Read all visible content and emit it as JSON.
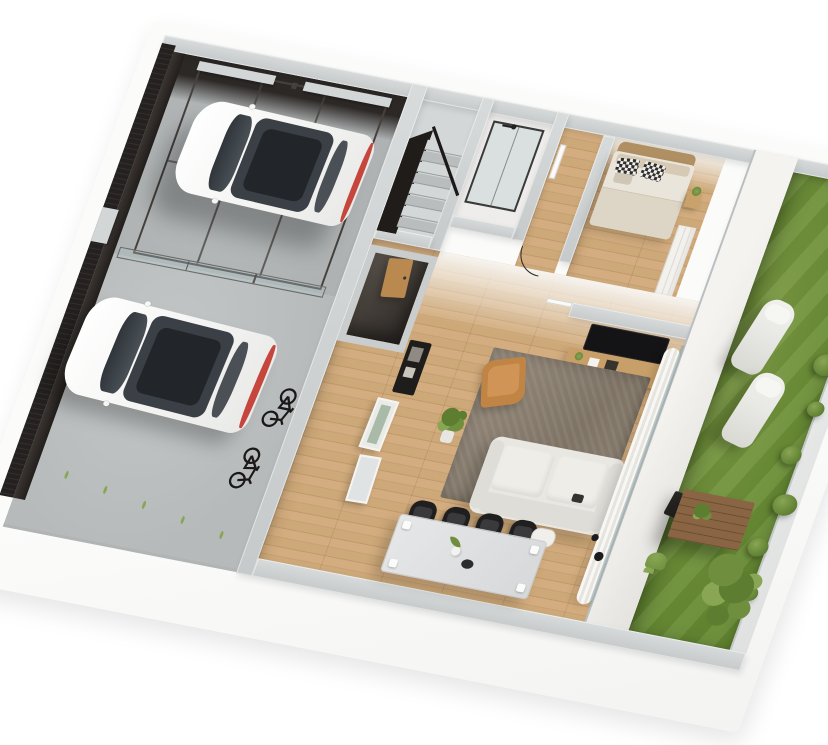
{
  "meta": {
    "title": "3D isometric cutaway floor plan render",
    "view": "top-down isometric, white background, no visible text"
  },
  "scene": {
    "areas": [
      {
        "name": "garage",
        "features": [
          "car-lift-cage",
          "white-suv-on-lift",
          "glass-garage-door",
          "dark-back-wall",
          "concrete-floor"
        ]
      },
      {
        "name": "driveway",
        "features": [
          "white-hatchback",
          "two-black-bicycles",
          "grass-tufts",
          "black-slatted-fence",
          "concrete-paving"
        ]
      },
      {
        "name": "staircase",
        "features": [
          "concrete-landing",
          "stair-treads",
          "black-stringer",
          "black-railing"
        ]
      },
      {
        "name": "bathroom",
        "features": [
          "glass-shower-enclosure",
          "black-shower-fixture"
        ]
      },
      {
        "name": "hallway",
        "features": [
          "door-swing-arc",
          "white-interior-door",
          "wood-floor"
        ]
      },
      {
        "name": "bedroom",
        "features": [
          "double-bed",
          "wood-headboard",
          "checkered-pillows",
          "nightstand-with-plant",
          "wardrobe"
        ]
      },
      {
        "name": "living-room",
        "features": [
          "wall-tv",
          "wood-media-console",
          "black-desk-lamp",
          "white-sofa",
          "taupe-rug",
          "tan-armchair",
          "potted-plant",
          "dining-table",
          "black-dining-chairs",
          "white-chair",
          "white-curtain",
          "glass-sliding-door",
          "entry-wood-door",
          "black-entry-console",
          "leaning-art-frames",
          "dark-storage-nook"
        ]
      },
      {
        "name": "garden",
        "features": [
          "lawn",
          "two-sun-loungers",
          "wooden-table-with-plant",
          "hedge-row",
          "tree",
          "corner-shrubs",
          "small-plant",
          "white-boundary-walls"
        ]
      }
    ]
  },
  "counts": {
    "stair_treads": 8,
    "dining_chairs": 4,
    "hedge_bushes": 8,
    "grass_tufts": 5,
    "lift_posts": 6,
    "cars": 2,
    "bicycles": 2,
    "sun_loungers": 2
  },
  "colors": {
    "platform": "#fbfbfa",
    "wallTop": "#c6cacb",
    "wallTopLight": "#d8dbdb",
    "wallWhite": "#f3f2ef",
    "wallShade": "#e4e3df",
    "fence": "#242120",
    "fenceSlat": "#322e2b",
    "darkWall": "#2c2826",
    "garageFloor": "#b7bbbc",
    "driveFloor": "#c3c6c6",
    "stairLight": "#d4d7d7",
    "stairDark": "#b9bdbe",
    "stringer": "#1f1c1a",
    "bathFloor": "#eeedeb",
    "glassTint": "rgba(176,196,201,0.33)",
    "glassFrame": "#3a3a3a",
    "wood1": "#d3ad7f",
    "wood2": "#c7a173",
    "wood3": "#cda878",
    "wood4": "#c19a6c",
    "woodLine": "rgba(122,86,49,0.16)",
    "storageDark": "#2e2a26",
    "storageLight": "#57504a",
    "rim": "#c9cdce",
    "bedFrame": "#b08f63",
    "mattress": "#eae5da",
    "blanket": "#ddd5c6",
    "pillowBeige": "#d6cab4",
    "check1": "#2e2e2e",
    "check2": "#f2efe9",
    "nightstand": "#c9a26b",
    "tv": "#141417",
    "consoleWood": "#c89f68",
    "curtainA": "#f8f7f4",
    "curtainB": "#e6e4df",
    "rugA": "#958a7c",
    "rugB": "#7e7365",
    "sofa": "#e9e7e2",
    "sofaDark": "#dfddd7",
    "cushion": "#efede8",
    "armchair": "#c08445",
    "tableTop": "#d6d8da",
    "chair": "#1f1f20",
    "whiteChair": "#f1efeb",
    "carBody": "#f4f4f2",
    "carGlass": "#3a4046",
    "carGlassDark": "#22262a",
    "tailRed": "#c6453c",
    "metal": "#46413c",
    "cap": "#d2d6d7",
    "grassA": "#7b9a43",
    "grassB": "#668a33",
    "lounger": "#e9e9e5",
    "gardenWood": "#8a6544",
    "gardenWoodLine": "#6e4f33",
    "bushDark": "#5d7d31",
    "bushMid": "#6f8f3f",
    "bushLight": "#88a653",
    "entryDoor": "#b9894f",
    "consoleBlack": "#1f1d1c",
    "frameArt": "#a9bba8"
  },
  "generated": [
    {
      "host": "stair-treads",
      "item": "stair-tread",
      "class": "tread",
      "count": 8
    },
    {
      "host": "dining-chairs",
      "item": "dining-chair",
      "class": "chair",
      "count": 4
    },
    {
      "host": "hedge-row",
      "item": "hedge-bush",
      "class": "bush",
      "count": 8
    },
    {
      "host": "grass-tufts",
      "item": "grass-tuft",
      "class": "tuft",
      "count": 5
    },
    {
      "host": "lift-posts",
      "item": "lift-post",
      "class": "post",
      "count": 6
    }
  ]
}
